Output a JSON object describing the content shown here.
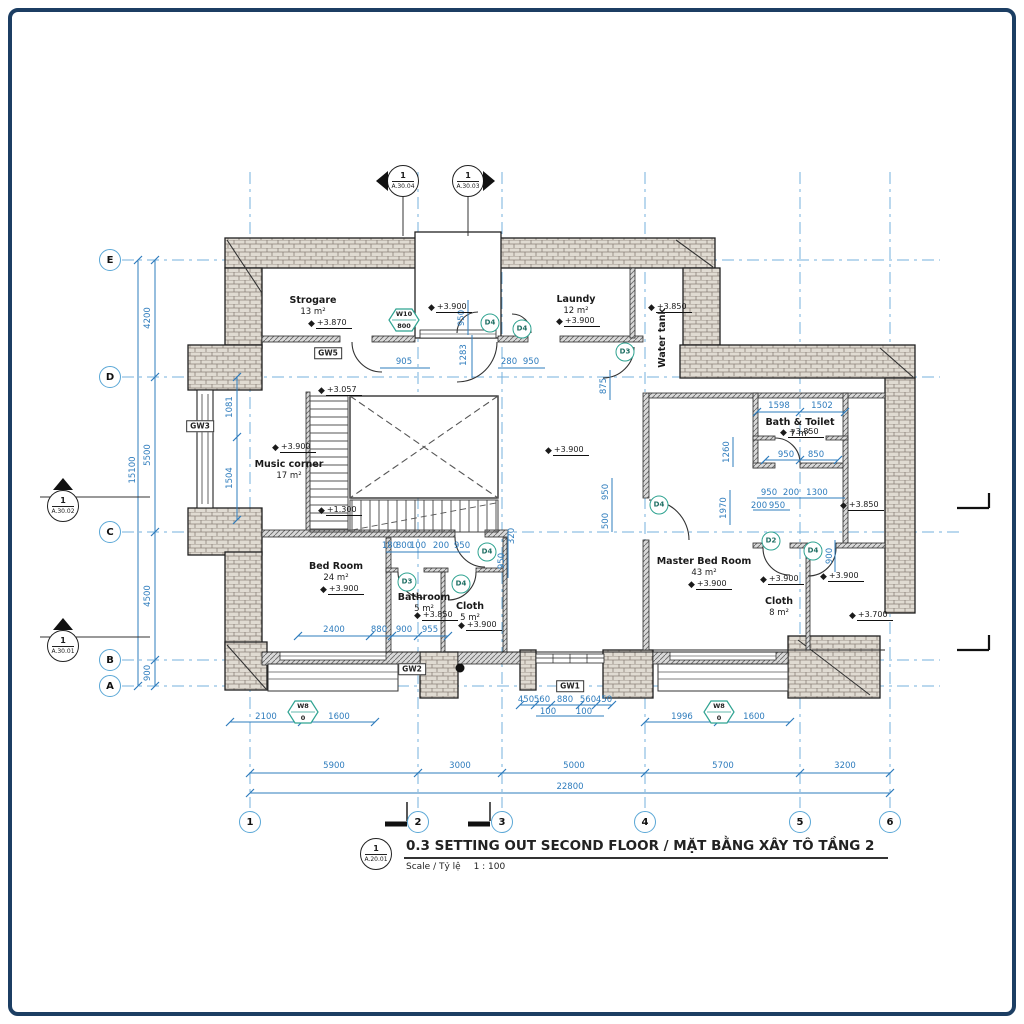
{
  "titleblock": {
    "marker_number": "1",
    "marker_sheet": "A.20.01",
    "title": "0.3 SETTING OUT SECOND FLOOR / MẶT BẰNG XÂY TÔ TẦNG 2",
    "scale_label": "Scale / Tỷ lệ",
    "scale_value": "1 : 100"
  },
  "grid": {
    "columns": [
      {
        "label": "1",
        "x": 250
      },
      {
        "label": "2",
        "x": 418
      },
      {
        "label": "3",
        "x": 502
      },
      {
        "label": "4",
        "x": 645
      },
      {
        "label": "5",
        "x": 800
      },
      {
        "label": "6",
        "x": 890
      }
    ],
    "columns_bubble_y": 822,
    "rows": [
      {
        "label": "E",
        "y": 260
      },
      {
        "label": "D",
        "y": 377
      },
      {
        "label": "C",
        "y": 532
      },
      {
        "label": "B",
        "y": 660
      },
      {
        "label": "A",
        "y": 686
      }
    ],
    "rows_bubble_x": 110
  },
  "rooms": [
    {
      "name": "Strogare",
      "area": "13 m²",
      "x": 313,
      "y": 295
    },
    {
      "name": "Laundy",
      "area": "12 m²",
      "x": 576,
      "y": 294
    },
    {
      "name": "Water tank",
      "area": "",
      "x": 663,
      "y": 338,
      "v": 1
    },
    {
      "name": "Music corner",
      "area": "17 m²",
      "x": 289,
      "y": 459
    },
    {
      "name": "Bed Room",
      "area": "24 m²",
      "x": 336,
      "y": 561
    },
    {
      "name": "Bathroom",
      "area": "5 m²",
      "x": 424,
      "y": 592
    },
    {
      "name": "Cloth",
      "area": "5 m²",
      "x": 470,
      "y": 601
    },
    {
      "name": "Master Bed Room",
      "area": "43 m²",
      "x": 704,
      "y": 556
    },
    {
      "name": "Bath & Toilet",
      "area": "7 m²",
      "x": 800,
      "y": 417
    },
    {
      "name": "Cloth",
      "area": "8 m²",
      "x": 779,
      "y": 596
    }
  ],
  "levels": [
    {
      "t": "+3.870",
      "x": 308,
      "y": 324
    },
    {
      "t": "+3.900",
      "x": 428,
      "y": 308
    },
    {
      "t": "+3.900",
      "x": 556,
      "y": 322
    },
    {
      "t": "+3.850",
      "x": 648,
      "y": 308
    },
    {
      "t": "+3.900",
      "x": 272,
      "y": 448
    },
    {
      "t": "+3.057",
      "x": 318,
      "y": 391
    },
    {
      "t": "+1.300",
      "x": 318,
      "y": 511
    },
    {
      "t": "+3.900",
      "x": 545,
      "y": 451
    },
    {
      "t": "+3.900",
      "x": 320,
      "y": 590
    },
    {
      "t": "+3.850",
      "x": 414,
      "y": 616
    },
    {
      "t": "+3.900",
      "x": 458,
      "y": 626
    },
    {
      "t": "+3.900",
      "x": 688,
      "y": 585
    },
    {
      "t": "+3.850",
      "x": 780,
      "y": 433
    },
    {
      "t": "+3.850",
      "x": 840,
      "y": 506
    },
    {
      "t": "+3.900",
      "x": 760,
      "y": 580
    },
    {
      "t": "+3.900",
      "x": 820,
      "y": 577
    },
    {
      "t": "+3.700",
      "x": 849,
      "y": 616
    }
  ],
  "dimensions": [
    {
      "t": "905",
      "x": 404,
      "y": 362
    },
    {
      "t": "1283",
      "x": 464,
      "y": 355,
      "v": 1
    },
    {
      "t": "280",
      "x": 509,
      "y": 362
    },
    {
      "t": "950",
      "x": 531,
      "y": 362
    },
    {
      "t": "950",
      "x": 462,
      "y": 318,
      "v": 1
    },
    {
      "t": "875",
      "x": 604,
      "y": 386,
      "v": 1
    },
    {
      "t": "1598",
      "x": 779,
      "y": 406
    },
    {
      "t": "1502",
      "x": 822,
      "y": 406
    },
    {
      "t": "950",
      "x": 786,
      "y": 455
    },
    {
      "t": "850",
      "x": 816,
      "y": 455
    },
    {
      "t": "950",
      "x": 769,
      "y": 493
    },
    {
      "t": "200",
      "x": 791,
      "y": 493
    },
    {
      "t": "1300",
      "x": 817,
      "y": 493
    },
    {
      "t": "200",
      "x": 759,
      "y": 506
    },
    {
      "t": "950",
      "x": 777,
      "y": 506
    },
    {
      "t": "1260",
      "x": 727,
      "y": 452,
      "v": 1
    },
    {
      "t": "1970",
      "x": 724,
      "y": 508,
      "v": 1
    },
    {
      "t": "950",
      "x": 606,
      "y": 492,
      "v": 1
    },
    {
      "t": "500",
      "x": 606,
      "y": 521,
      "v": 1
    },
    {
      "t": "900",
      "x": 830,
      "y": 556,
      "v": 1
    },
    {
      "t": "180",
      "x": 390,
      "y": 546
    },
    {
      "t": "800",
      "x": 404,
      "y": 546
    },
    {
      "t": "100",
      "x": 418,
      "y": 546
    },
    {
      "t": "200",
      "x": 441,
      "y": 546
    },
    {
      "t": "950",
      "x": 462,
      "y": 546
    },
    {
      "t": "320",
      "x": 512,
      "y": 536,
      "v": 1
    },
    {
      "t": "950",
      "x": 502,
      "y": 561,
      "v": 1
    },
    {
      "t": "2400",
      "x": 334,
      "y": 630
    },
    {
      "t": "880",
      "x": 379,
      "y": 630
    },
    {
      "t": "900",
      "x": 404,
      "y": 630
    },
    {
      "t": "955",
      "x": 430,
      "y": 630
    },
    {
      "t": "2100",
      "x": 266,
      "y": 717
    },
    {
      "t": "1600",
      "x": 339,
      "y": 717
    },
    {
      "t": "450",
      "x": 526,
      "y": 700
    },
    {
      "t": "560",
      "x": 542,
      "y": 700
    },
    {
      "t": "880",
      "x": 565,
      "y": 700
    },
    {
      "t": "560",
      "x": 588,
      "y": 700
    },
    {
      "t": "450",
      "x": 604,
      "y": 700
    },
    {
      "t": "100",
      "x": 548,
      "y": 712
    },
    {
      "t": "100",
      "x": 584,
      "y": 712
    },
    {
      "t": "1996",
      "x": 682,
      "y": 717
    },
    {
      "t": "1600",
      "x": 754,
      "y": 717
    },
    {
      "t": "5900",
      "x": 334,
      "y": 766
    },
    {
      "t": "3000",
      "x": 460,
      "y": 766
    },
    {
      "t": "5000",
      "x": 574,
      "y": 766
    },
    {
      "t": "5700",
      "x": 723,
      "y": 766
    },
    {
      "t": "3200",
      "x": 845,
      "y": 766
    },
    {
      "t": "22800",
      "x": 570,
      "y": 787
    },
    {
      "t": "4200",
      "x": 148,
      "y": 318,
      "v": 1
    },
    {
      "t": "5500",
      "x": 148,
      "y": 455,
      "v": 1
    },
    {
      "t": "4500",
      "x": 148,
      "y": 596,
      "v": 1
    },
    {
      "t": "900",
      "x": 148,
      "y": 673,
      "v": 1
    },
    {
      "t": "15100",
      "x": 133,
      "y": 470,
      "v": 1
    },
    {
      "t": "1081",
      "x": 230,
      "y": 407,
      "v": 1
    },
    {
      "t": "1504",
      "x": 230,
      "y": 478,
      "v": 1
    }
  ],
  "door_tags": [
    {
      "t": "D4",
      "x": 490,
      "y": 323
    },
    {
      "t": "D4",
      "x": 522,
      "y": 329
    },
    {
      "t": "D3",
      "x": 625,
      "y": 352
    },
    {
      "t": "D4",
      "x": 487,
      "y": 552
    },
    {
      "t": "D3",
      "x": 407,
      "y": 582
    },
    {
      "t": "D4",
      "x": 461,
      "y": 584
    },
    {
      "t": "D4",
      "x": 659,
      "y": 505
    },
    {
      "t": "D2",
      "x": 771,
      "y": 541
    },
    {
      "t": "D4",
      "x": 813,
      "y": 551
    }
  ],
  "window_tags": [
    {
      "l1": "W10",
      "l2": "800",
      "x": 404,
      "y": 320
    },
    {
      "l1": "W8",
      "l2": "0",
      "x": 303,
      "y": 712
    },
    {
      "l1": "W8",
      "l2": "0",
      "x": 719,
      "y": 712
    }
  ],
  "wall_tags": [
    {
      "t": "GW5",
      "x": 328,
      "y": 353
    },
    {
      "t": "GW3",
      "x": 200,
      "y": 426
    },
    {
      "t": "GW2",
      "x": 412,
      "y": 669
    },
    {
      "t": "GW1",
      "x": 570,
      "y": 686
    }
  ],
  "section_markers": [
    {
      "num": "1",
      "sheet": "A.30.04",
      "x": 403,
      "y": 181,
      "tri": "left"
    },
    {
      "num": "1",
      "sheet": "A.30.03",
      "x": 468,
      "y": 181,
      "tri": "right"
    },
    {
      "num": "1",
      "sheet": "A.30.02",
      "x": 63,
      "y": 506,
      "tri": "up"
    },
    {
      "num": "1",
      "sheet": "A.30.01",
      "x": 63,
      "y": 646,
      "tri": "up"
    }
  ],
  "colors": {
    "dimension_blue": "#2e7cbd",
    "grid_blue": "#74b2dd",
    "wall_line": "#222222",
    "brick_fill": "#e0dbd2",
    "door_tag_teal": "#2fa391",
    "frame_navy": "#1c3e63"
  }
}
